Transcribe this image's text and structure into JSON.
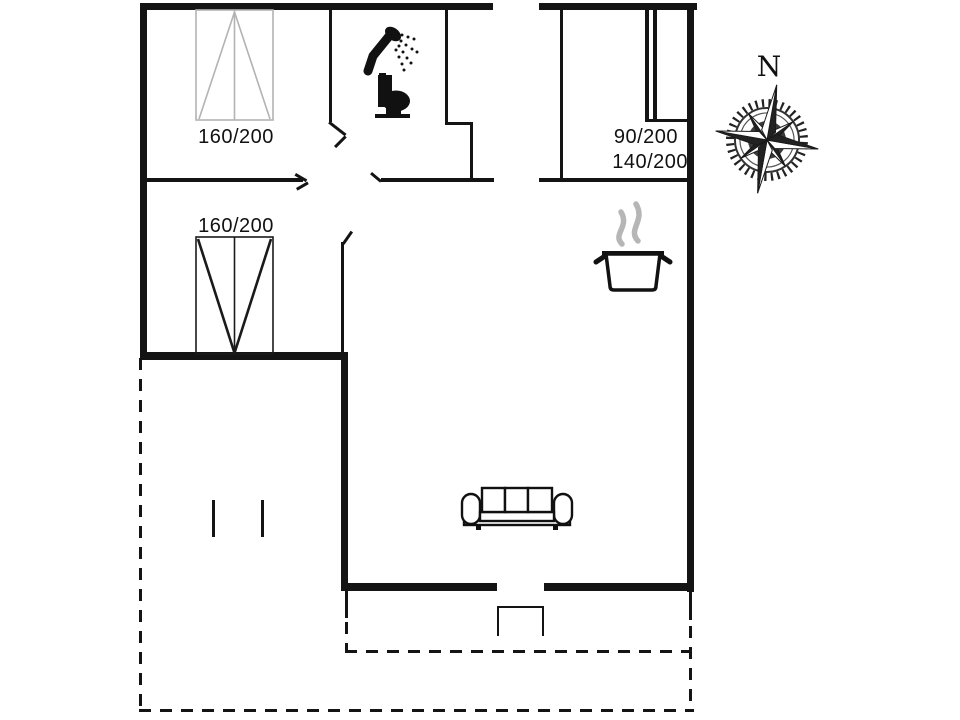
{
  "plan_title": "holiday-home-floor-plan",
  "colors": {
    "ink": "#141414",
    "bed_light_gray": "#b3b3b3",
    "steam_gray": "#b6b6b6",
    "background": "#ffffff"
  },
  "labels": {
    "bed_top_left": "160/200",
    "bed_mid_left": "160/200",
    "bunk_top": "90/200",
    "bunk_bottom": "140/200",
    "compass_north": "N"
  },
  "icons": {
    "shower": "shower-icon",
    "toilet": "toilet-icon",
    "stove_pot": "steaming-pot-icon",
    "sofa": "sofa-icon",
    "compass": "compass-rose-icon",
    "bed_double": "double-bed-icon",
    "bed_bunk": "bunk-bed-icon"
  }
}
